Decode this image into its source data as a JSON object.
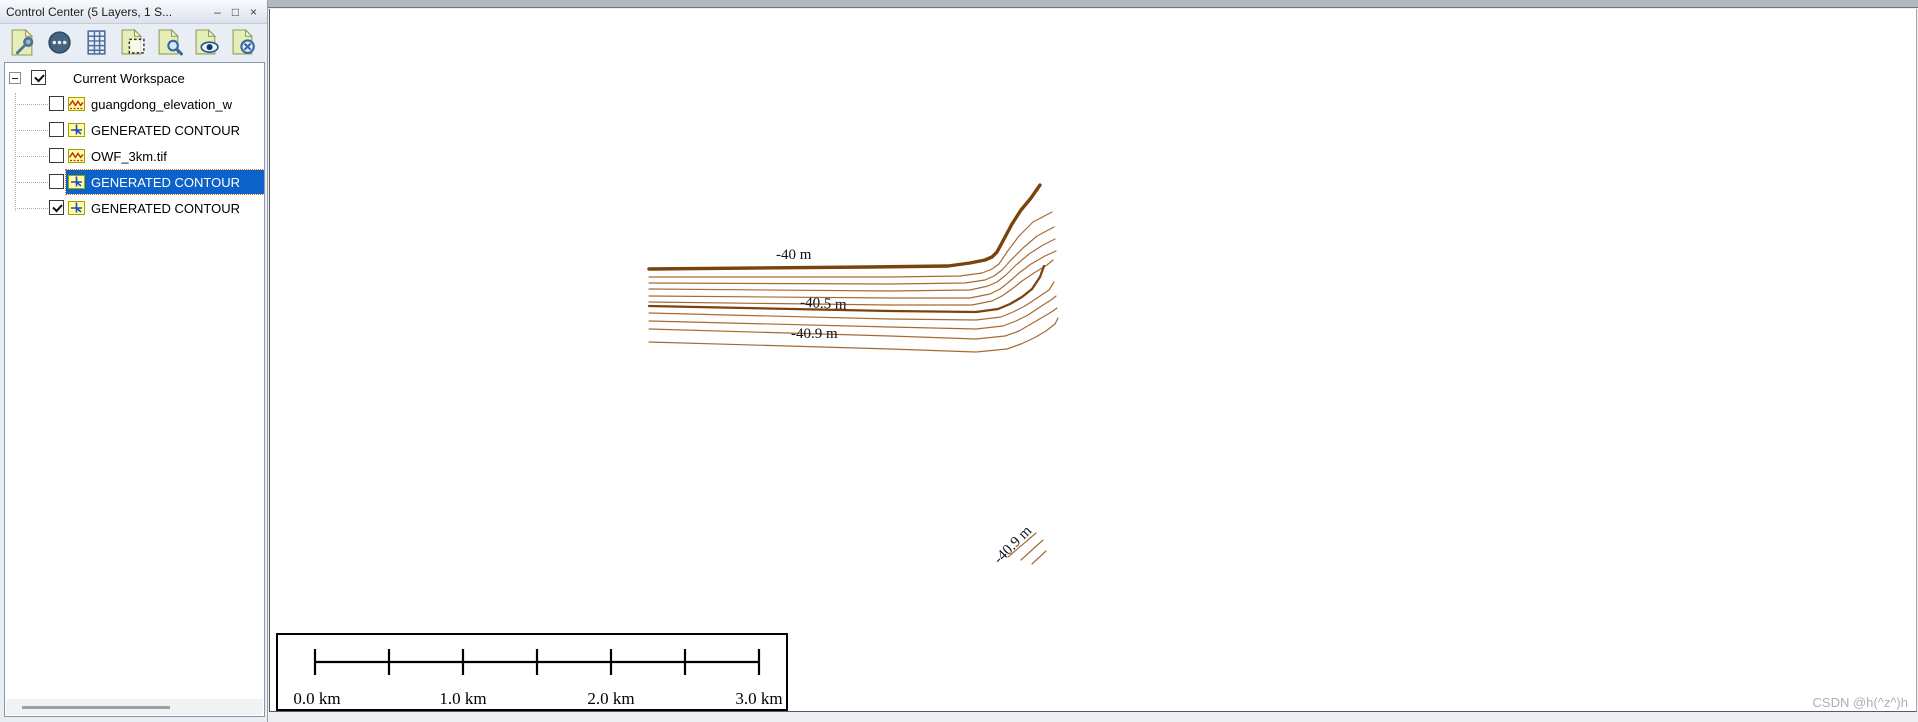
{
  "window": {
    "title": "Control Center (5 Layers, 1 S...",
    "minimize": "–",
    "maximize": "□",
    "close": "×"
  },
  "toolbar": {
    "icons": [
      "layer-options",
      "metadata",
      "attribute-table",
      "crop-selection",
      "zoom-to-layer",
      "show-layer",
      "hide-layer"
    ]
  },
  "tree": {
    "root": {
      "label": "Current Workspace",
      "checked": true,
      "expanded": true
    },
    "layers": [
      {
        "label": "guangdong_elevation_w",
        "type": "raster",
        "checked": false,
        "selected": false
      },
      {
        "label": "GENERATED CONTOUR",
        "type": "vector",
        "checked": false,
        "selected": false
      },
      {
        "label": "OWF_3km.tif",
        "type": "raster",
        "checked": false,
        "selected": false
      },
      {
        "label": "GENERATED CONTOUR",
        "type": "vector",
        "checked": false,
        "selected": true
      },
      {
        "label": "GENERATED CONTOUR",
        "type": "vector",
        "checked": true,
        "selected": false
      }
    ]
  },
  "map": {
    "colors": {
      "major_contour": "#7a430e",
      "minor_contour": "#a86a33",
      "label": "#101020"
    },
    "labels": [
      {
        "text": "-40 m"
      },
      {
        "text": "-40.5 m"
      },
      {
        "text": "-40.9 m"
      },
      {
        "text": "-40.9 m"
      }
    ],
    "contours": [
      {
        "d": "M379,260 L600,258 L678,257 L700,254 L715,251 L722,248 L727,243 L734,230 L742,215 L751,201 L761,189 L770,176"
      },
      {
        "d": "M379,268 L620,268 L690,267 L712,264 L722,260 L729,255 L737,243 L749,227 L763,213 L782,203"
      },
      {
        "d": "M379,274 L620,275 L695,274 L715,271 L724,267 L732,261 L741,251 L753,239 L767,227 L784,218"
      },
      {
        "d": "M379,280 L620,282 L700,281 L718,277 L727,273 L736,266 L746,256 L759,245 L773,236 L785,230"
      },
      {
        "d": "M379,287 L620,289 L700,289 L720,285 L730,280 L739,273 L749,264 L761,255 L775,247 L786,242"
      },
      {
        "d": "M379,293 L620,296 L702,296 L722,292 L732,287 L742,280 L752,272 L764,264 L777,256 L783,251"
      },
      {
        "d": "M379,297 L620,302 L706,303 L728,300 L740,295 L752,288 L762,280 L770,268 L774,257"
      },
      {
        "d": "M379,304 L620,310 L706,311 L731,308 L743,303 L755,297 L767,289 L779,281 L784,273"
      },
      {
        "d": "M379,312 L620,318 L706,320 L733,317 L746,312 L758,306 L770,298 L781,291 L786,287"
      },
      {
        "d": "M379,320 L620,327 L706,330 L735,327 L749,322 L761,315 L773,308 L783,302 L787,299"
      },
      {
        "d": "M379,333 L620,340 L706,343 L737,340 L751,335 L764,329 L776,322 L785,315 L788,309"
      },
      {
        "d": "M738,548 L766,524"
      },
      {
        "d": "M751,551 L773,531"
      },
      {
        "d": "M762,555 L776,542"
      }
    ],
    "watermark": "CSDN @h(^z^)h"
  },
  "scalebar": {
    "labels": [
      "0.0 km",
      "1.0 km",
      "2.0 km",
      "3.0 km"
    ]
  }
}
